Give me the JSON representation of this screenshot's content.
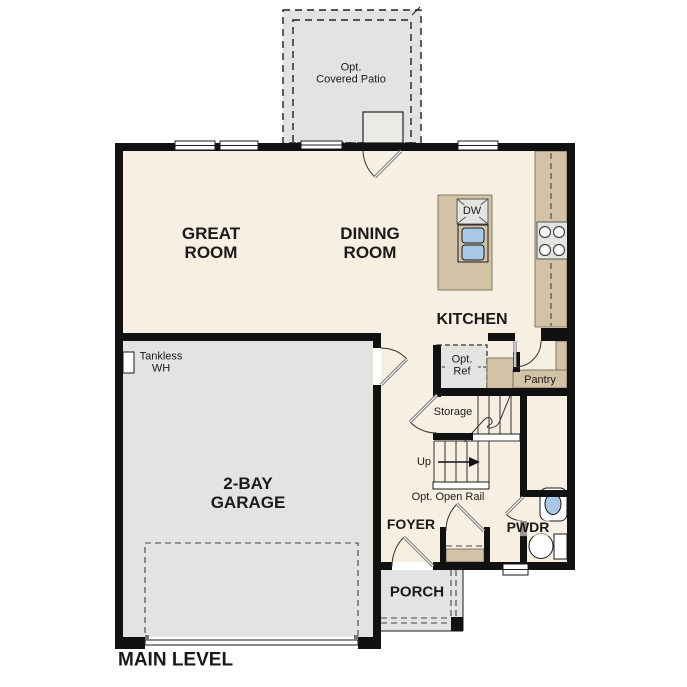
{
  "plan": {
    "level_label": "MAIN LEVEL",
    "rooms": {
      "patio": "Opt.\nCovered Patio",
      "great_room": "GREAT\nROOM",
      "dining_room": "DINING\nROOM",
      "kitchen": "KITCHEN",
      "garage": "2-BAY\nGARAGE",
      "foyer": "FOYER",
      "powder": "PWDR",
      "porch": "PORCH",
      "pantry": "Pantry",
      "storage": "Storage"
    },
    "annotations": {
      "tankless_wh": "Tankless\nWH",
      "opt_ref": "Opt.\nRef",
      "dishwasher": "DW",
      "stairs_up": "Up",
      "opt_open_rail": "Opt. Open Rail"
    },
    "colors": {
      "floor_cream": "#f7efe2",
      "concrete_gray": "#e3e3e1",
      "counter_tan": "#d2c3a6",
      "sink_blue": "#a9c8e8",
      "wall_black": "#111111"
    }
  }
}
